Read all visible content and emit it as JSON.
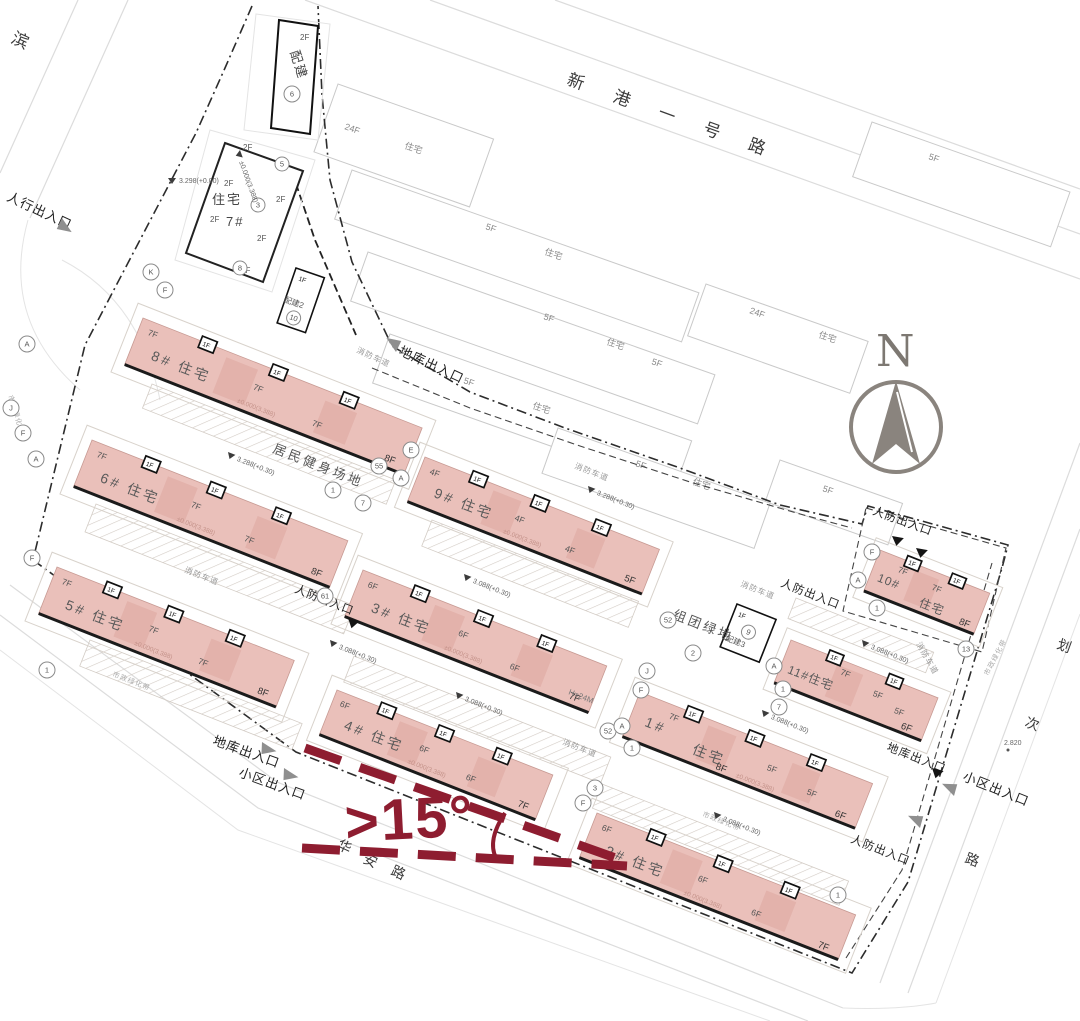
{
  "site": {
    "north_label": "N",
    "angle_annotation": ">15°",
    "height_note": "H=24M"
  },
  "colors": {
    "building_fill": "#eac0ba",
    "accent_red": "#8e1d30"
  },
  "roads": {
    "top": [
      "新",
      "港",
      "一",
      "号",
      "路"
    ],
    "left": [
      "滨"
    ],
    "bottom": [
      "华",
      "安",
      "路"
    ],
    "right": [
      "划",
      "次",
      "路"
    ]
  },
  "entrance_labels": {
    "pedestrian": "人行出入口",
    "garage": "地库出入口",
    "community": "小区出入口",
    "civil_defense": "人防出入口"
  },
  "area_labels": {
    "fitness": "居民健身场地",
    "cluster_green": "组团绿地",
    "fire_lane": "消防车道",
    "green_belt": "市政绿化带"
  },
  "ancillary": {
    "peijian1": {
      "name": "配建",
      "floor": "2F",
      "circle": "6"
    },
    "peijian2": {
      "name": "配建2",
      "floor": "1F",
      "circle": "10"
    },
    "peijian3": {
      "name": "配建3",
      "floor": "1F",
      "circle": "9"
    },
    "res7": {
      "name_l1": "住宅",
      "name_l2": "7#",
      "floor": "2F",
      "circles": [
        "3",
        "5",
        "8"
      ]
    }
  },
  "buildings": [
    {
      "name": "8# 住宅",
      "unit": "7F",
      "entry": "1F",
      "end": "8F",
      "elev": "±0.000(3.388)"
    },
    {
      "name": "6# 住宅",
      "unit": "7F",
      "entry": "1F",
      "end": "8F",
      "elev": "±0.000(3.388)"
    },
    {
      "name": "9# 住宅",
      "unit": "4F",
      "entry": "1F",
      "end": "5F",
      "elev": "±0.000(3.388)"
    },
    {
      "name": "5# 住宅",
      "unit": "7F",
      "entry": "1F",
      "end": "8F",
      "elev": "±0.000(3.388)"
    },
    {
      "name": "3# 住宅",
      "unit": "6F",
      "entry": "1F",
      "end": "7F",
      "elev": "±0.000(3.388)"
    },
    {
      "name": "4# 住宅",
      "unit": "6F",
      "entry": "1F",
      "end": "7F",
      "elev": "±0.000(3.388)"
    },
    {
      "name": "1#",
      "name2": "住宅",
      "unit": "7F",
      "unit2": "5F",
      "entry": "1F",
      "end": "6F",
      "extra": "8F",
      "elev": "±0.000(3.388)"
    },
    {
      "name": "2# 住宅",
      "unit": "6F",
      "entry": "1F",
      "end": "7F",
      "elev": "±0.000(3.388)"
    },
    {
      "name": "10#",
      "name2": "住宅",
      "unit": "7F",
      "entry": "1F",
      "end": "8F",
      "elev": "±0.000(3.388)"
    },
    {
      "name": "11#住宅",
      "unit": "7F",
      "unit2": "5F",
      "entry": "1F",
      "end": "6F",
      "elev": "±0.000(3.388)"
    }
  ],
  "neighbors": {
    "res": "住宅",
    "f5": "5F",
    "f24": "24F"
  },
  "elevations": [
    "3.298(+0.00)",
    "±0.000(3.388)",
    "3.288(+0.30)",
    "3.288(+0.30)",
    "3.088(+0.30)",
    "3.088(+0.30)",
    "3.088(+0.30)",
    "3.088(+0.30)",
    "3.088(+0.30)",
    "3.088(+0.30)",
    "2.820"
  ],
  "bubbles": [
    "K",
    "F",
    "A",
    "J",
    "F",
    "A",
    "E",
    "A",
    "1",
    "55",
    "7",
    "F",
    "61",
    "1",
    "52",
    "J",
    "F",
    "2",
    "A",
    "1",
    "7",
    "1",
    "F",
    "A",
    "13",
    "1",
    "3",
    "F",
    "52",
    "A",
    "1"
  ]
}
